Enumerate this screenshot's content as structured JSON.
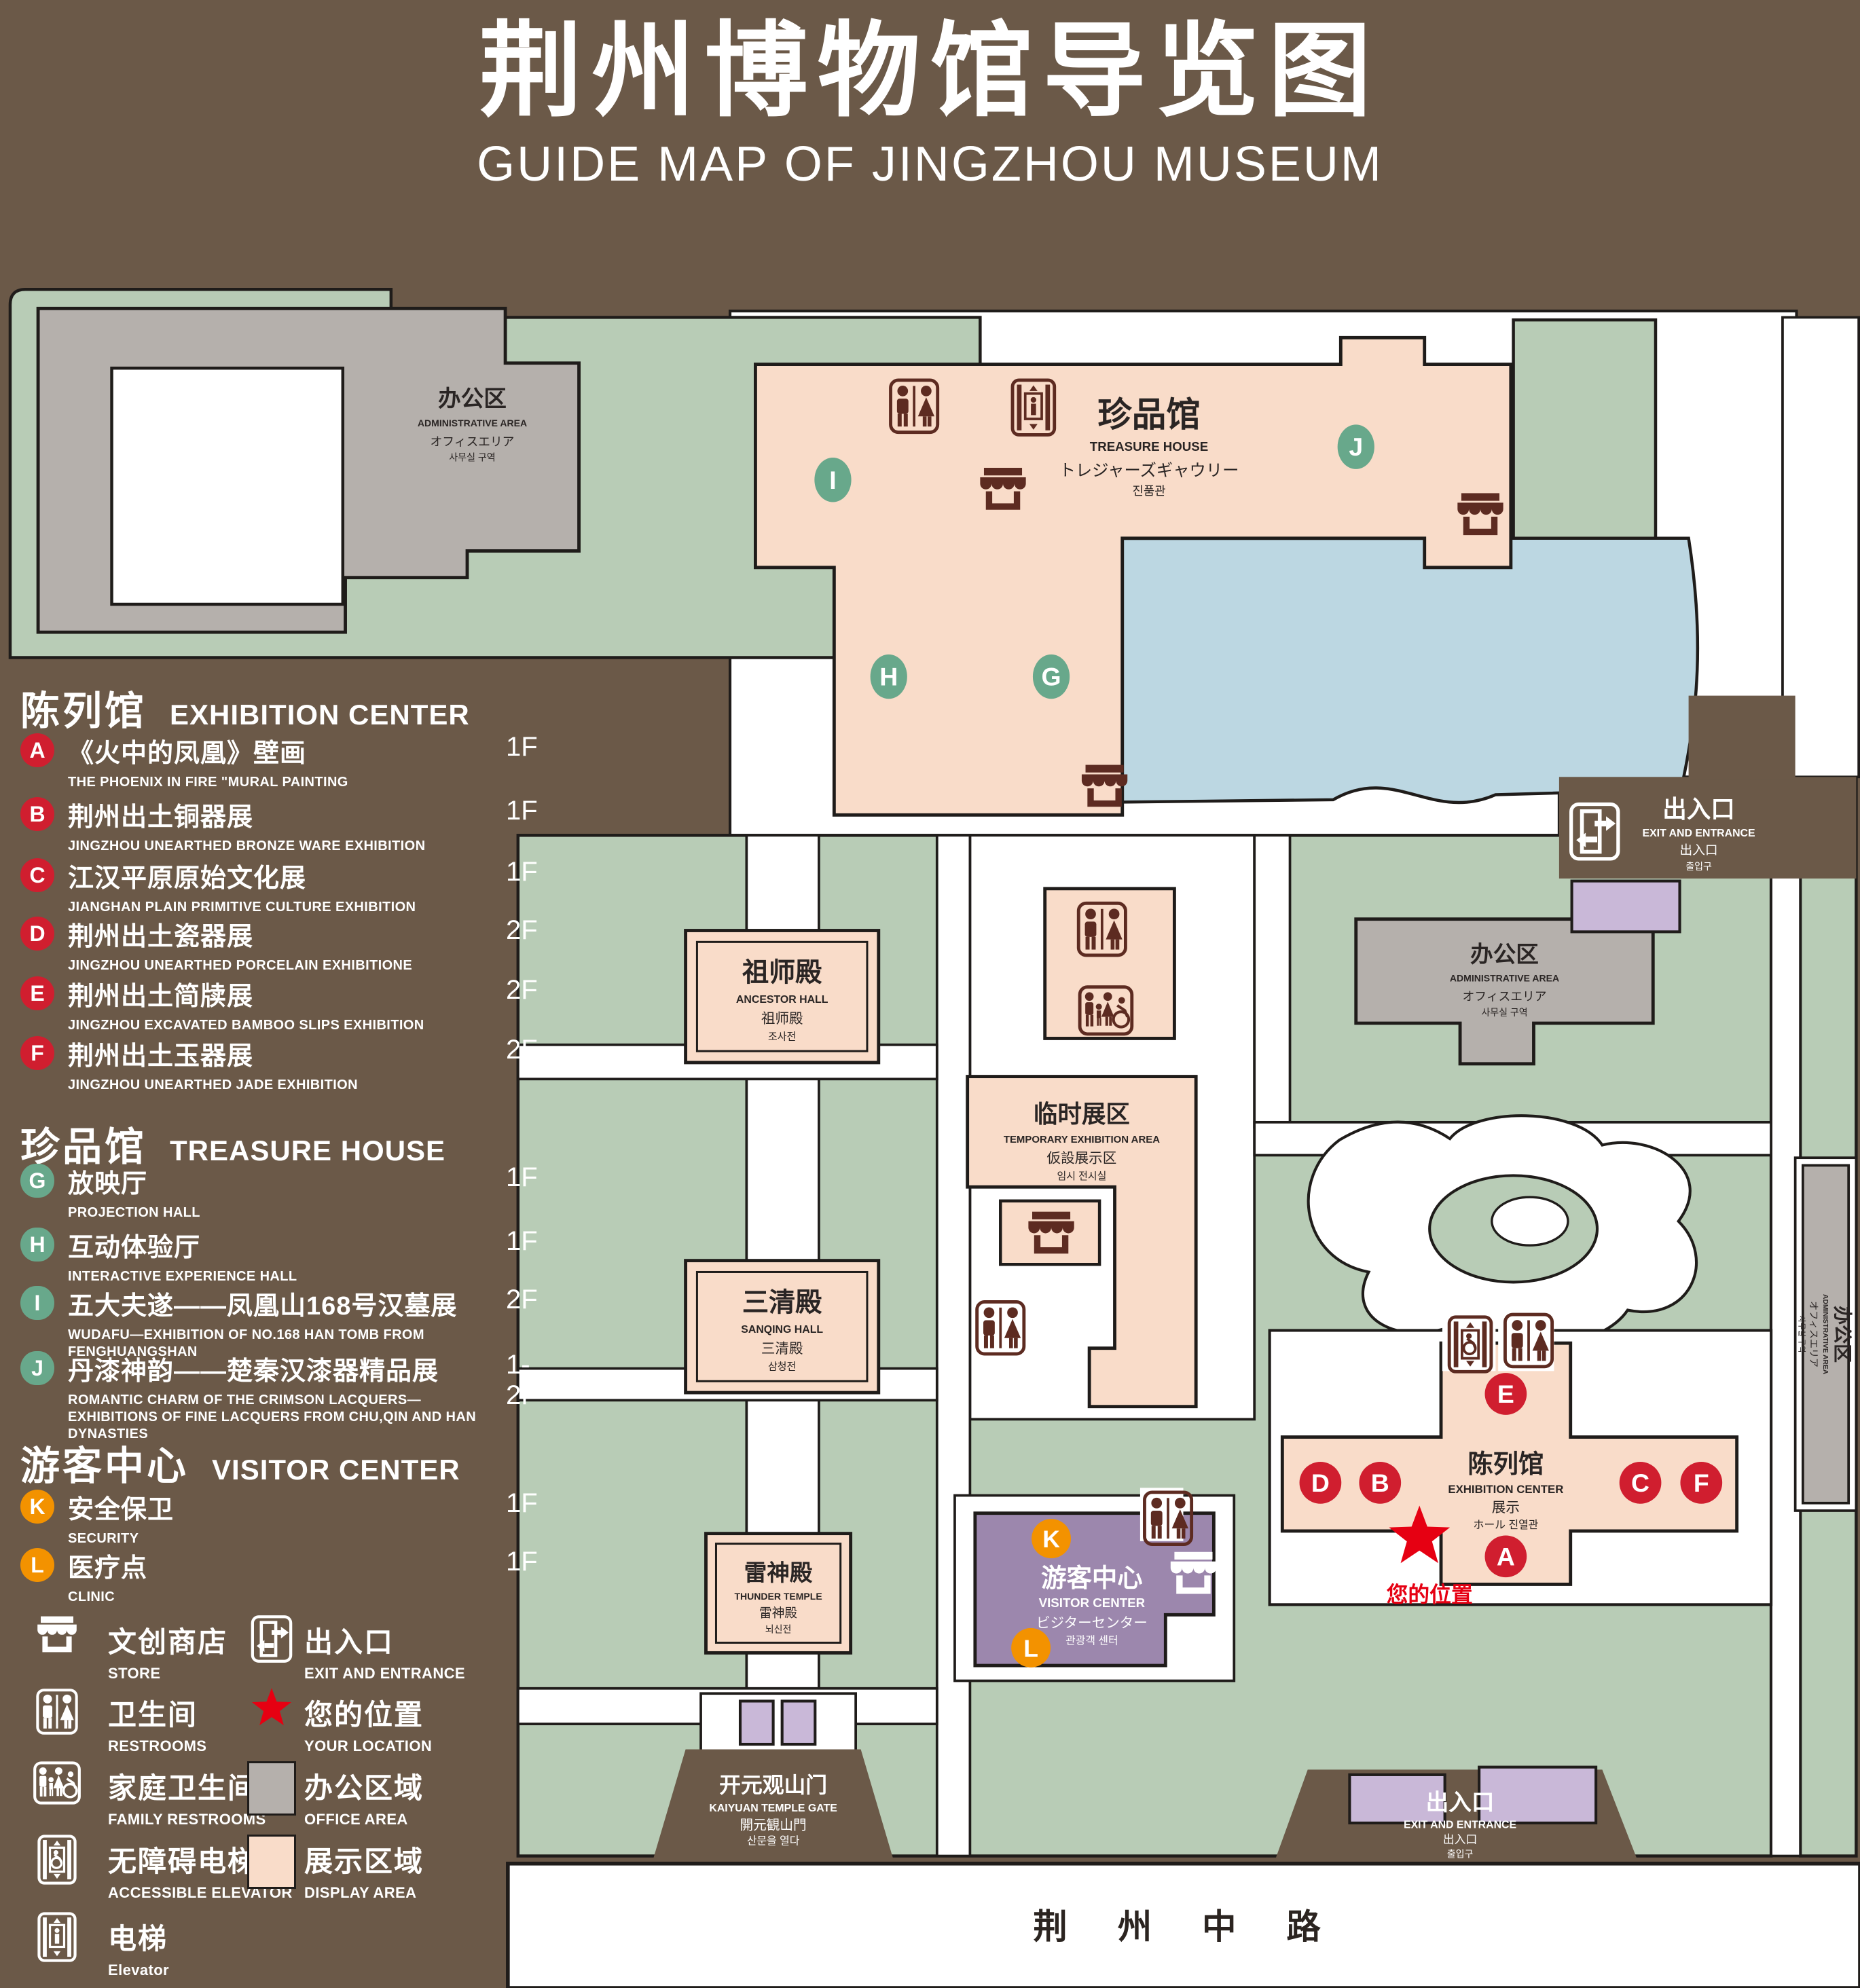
{
  "title": {
    "zh": "荆州博物馆导览图",
    "en": "GUIDE MAP OF JINGZHOU MUSEUM"
  },
  "colors": {
    "background": "#6b5948",
    "lawn": "#b8ccb6",
    "display_area": "#f9dcc9",
    "office_area": "#b5b0ac",
    "lake": "#bcd7e2",
    "visitor_center": "#9c87ad",
    "booth": "#c9b8d8",
    "marker_red": "#d01e2f",
    "marker_green": "#68a88b",
    "marker_orange": "#f39200",
    "icon_maroon": "#5d2b21",
    "location_red": "#e60012"
  },
  "legend": {
    "sections": [
      {
        "zh": "陈列馆",
        "en": "EXHIBITION CENTER",
        "items": [
          {
            "letter": "A",
            "zh": "《火中的凤凰》壁画",
            "en": "THE PHOENIX IN FIRE \"MURAL PAINTING",
            "floor": "1F"
          },
          {
            "letter": "B",
            "zh": "荆州出土铜器展",
            "en": "JINGZHOU UNEARTHED BRONZE WARE EXHIBITION",
            "floor": "1F"
          },
          {
            "letter": "C",
            "zh": "江汉平原原始文化展",
            "en": "JIANGHAN PLAIN PRIMITIVE CULTURE EXHIBITION",
            "floor": "1F"
          },
          {
            "letter": "D",
            "zh": "荆州出土瓷器展",
            "en": "JINGZHOU UNEARTHED PORCELAIN EXHIBITIONE",
            "floor": "2F"
          },
          {
            "letter": "E",
            "zh": "荆州出土简牍展",
            "en": "JINGZHOU EXCAVATED BAMBOO SLIPS EXHIBITION",
            "floor": "2F"
          },
          {
            "letter": "F",
            "zh": "荆州出土玉器展",
            "en": "JINGZHOU UNEARTHED JADE EXHIBITION",
            "floor": "2F"
          }
        ]
      },
      {
        "zh": "珍品馆",
        "en": "TREASURE HOUSE",
        "items": [
          {
            "letter": "G",
            "zh": "放映厅",
            "en": "PROJECTION HALL",
            "floor": "1F"
          },
          {
            "letter": "H",
            "zh": "互动体验厅",
            "en": "INTERACTIVE EXPERIENCE HALL",
            "floor": "1F"
          },
          {
            "letter": "I",
            "zh": "五大夫遂——凤凰山168号汉墓展",
            "en": "WUDAFU—EXHIBITION OF NO.168 HAN TOMB FROM FENGHUANGSHAN",
            "floor": "2F"
          },
          {
            "letter": "J",
            "zh": "丹漆神韵——楚秦汉漆器精品展",
            "en": "ROMANTIC CHARM OF THE CRIMSON LACQUERS—EXHIBITIONS OF FINE LACQUERS FROM CHU,QIN AND HAN DYNASTIES",
            "floor": "1-2F"
          }
        ]
      },
      {
        "zh": "游客中心",
        "en": "VISITOR CENTER",
        "items": [
          {
            "letter": "K",
            "zh": "安全保卫",
            "en": "SECURITY",
            "floor": "1F"
          },
          {
            "letter": "L",
            "zh": "医疗点",
            "en": "CLINIC",
            "floor": "1F"
          }
        ]
      }
    ],
    "symbols_left": [
      {
        "icon": "store-icon",
        "zh": "文创商店",
        "en": "STORE"
      },
      {
        "icon": "restrooms-icon",
        "zh": "卫生间",
        "en": "RESTROOMS"
      },
      {
        "icon": "family-restrooms-icon",
        "zh": "家庭卫生间",
        "en": "FAMILY RESTROOMS"
      },
      {
        "icon": "accessible-elevator-icon",
        "zh": "无障碍电梯",
        "en": "ACCESSIBLE  ELEVATOR"
      },
      {
        "icon": "elevator-icon",
        "zh": "电梯",
        "en": "Elevator"
      }
    ],
    "symbols_right": [
      {
        "icon": "exit-icon",
        "zh": "出入口",
        "en": "EXIT AND ENTRANCE"
      },
      {
        "icon": "location-star-icon",
        "zh": "您的位置",
        "en": "YOUR LOCATION"
      },
      {
        "icon": "office-swatch",
        "zh": "办公区域",
        "en": "OFFICE AREA"
      },
      {
        "icon": "display-swatch",
        "zh": "展示区域",
        "en": "DISPLAY AREA"
      }
    ]
  },
  "map": {
    "buildings": {
      "treasure_house": {
        "zh": "珍品馆",
        "en": "TREASURE HOUSE",
        "ja": "トレジャーズギャウリー",
        "ko": "진품관"
      },
      "admin": {
        "zh": "办公区",
        "en": "ADMINISTRATIVE AREA",
        "ja": "オフィスエリア",
        "ko": "사무실 구역"
      },
      "ancestor_hall": {
        "zh": "祖师殿",
        "en": "ANCESTOR HALL",
        "ja": "祖师殿",
        "ko": "조사전"
      },
      "sanqing_hall": {
        "zh": "三清殿",
        "en": "SANQING HALL",
        "ja": "三清殿",
        "ko": "삼청전"
      },
      "thunder_temple": {
        "zh": "雷神殿",
        "en": "THUNDER TEMPLE",
        "ja": "雷神殿",
        "ko": "뇌신전"
      },
      "temporary": {
        "zh": "临时展区",
        "en": "TEMPORARY EXHIBITION AREA",
        "ja": "仮設展示区",
        "ko": "임시 전시실"
      },
      "exhibition_center": {
        "zh": "陈列馆",
        "en": "EXHIBITION CENTER",
        "ja": "展示",
        "ko": "ホール 진열관"
      },
      "visitor_center": {
        "zh": "游客中心",
        "en": "VISITOR CENTER",
        "ja": "ビジターセンター",
        "ko": "관광객 센터"
      },
      "gate": {
        "zh": "开元观山门",
        "en": "KAIYUAN TEMPLE GATE",
        "ja": "開元観山門",
        "ko": "산문을 열다"
      },
      "exit": {
        "zh": "出入口",
        "en": "EXIT AND ENTRANCE",
        "ja": "出入口",
        "ko": "출입구"
      },
      "road": {
        "zh": "荆 州 中 路"
      }
    },
    "letters": {
      "A": "A",
      "B": "B",
      "C": "C",
      "D": "D",
      "E": "E",
      "F": "F",
      "G": "G",
      "H": "H",
      "I": "I",
      "J": "J",
      "K": "K",
      "L": "L"
    },
    "your_location": "您的位置"
  }
}
